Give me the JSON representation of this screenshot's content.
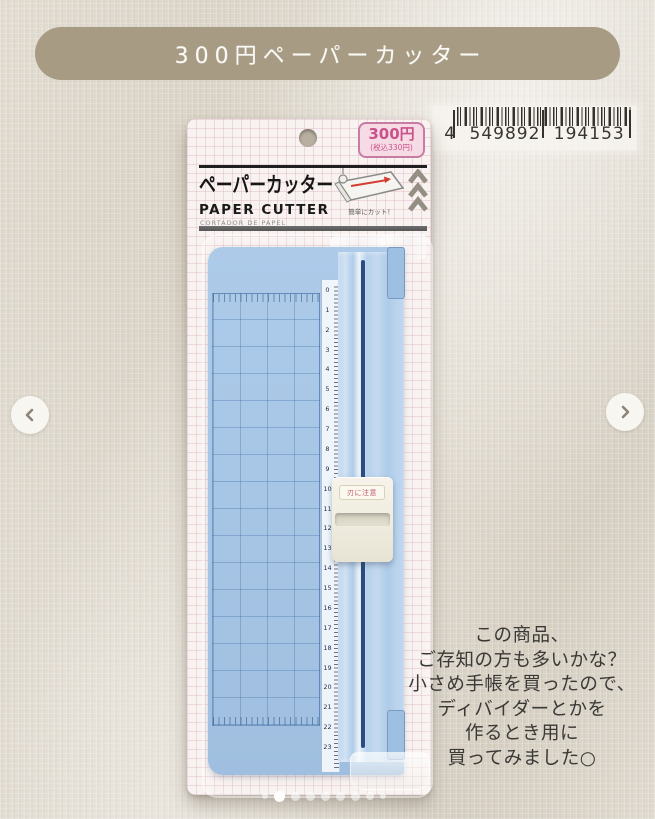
{
  "banner": {
    "label": "300円ペーパーカッター",
    "bg_color": "#a79b84",
    "text_color": "#fbfaf6"
  },
  "barcode": {
    "digits": "4 549892 194153"
  },
  "package": {
    "price_badge": {
      "price": "300円",
      "tax_note": "(税込330円)",
      "accent_color": "#c9528a"
    },
    "title_jp": "ペーパーカッター",
    "title_en": "PAPER CUTTER",
    "subtitle_es": "CORTADOR DE PAPEL",
    "illustration_caption": "簡単にカット！",
    "slider_warning_label": "刃に注意",
    "body_color": "#a6c4e4",
    "ruler": {
      "unit_max": 23,
      "numbers": [
        0,
        1,
        2,
        3,
        4,
        5,
        6,
        7,
        8,
        9,
        10,
        11,
        12,
        13,
        14,
        15,
        16,
        17,
        18,
        19,
        20,
        21,
        22,
        23
      ]
    }
  },
  "caption": {
    "lines": [
      "この商品、",
      "ご存知の方も多いかな？",
      "小さめ手帳を買ったので、",
      "ディバイダーとかを",
      "作るとき用に",
      "買ってみました○"
    ],
    "text_color": "#3a3936"
  },
  "carousel": {
    "dots": {
      "count": 9,
      "active_index": 1
    }
  }
}
